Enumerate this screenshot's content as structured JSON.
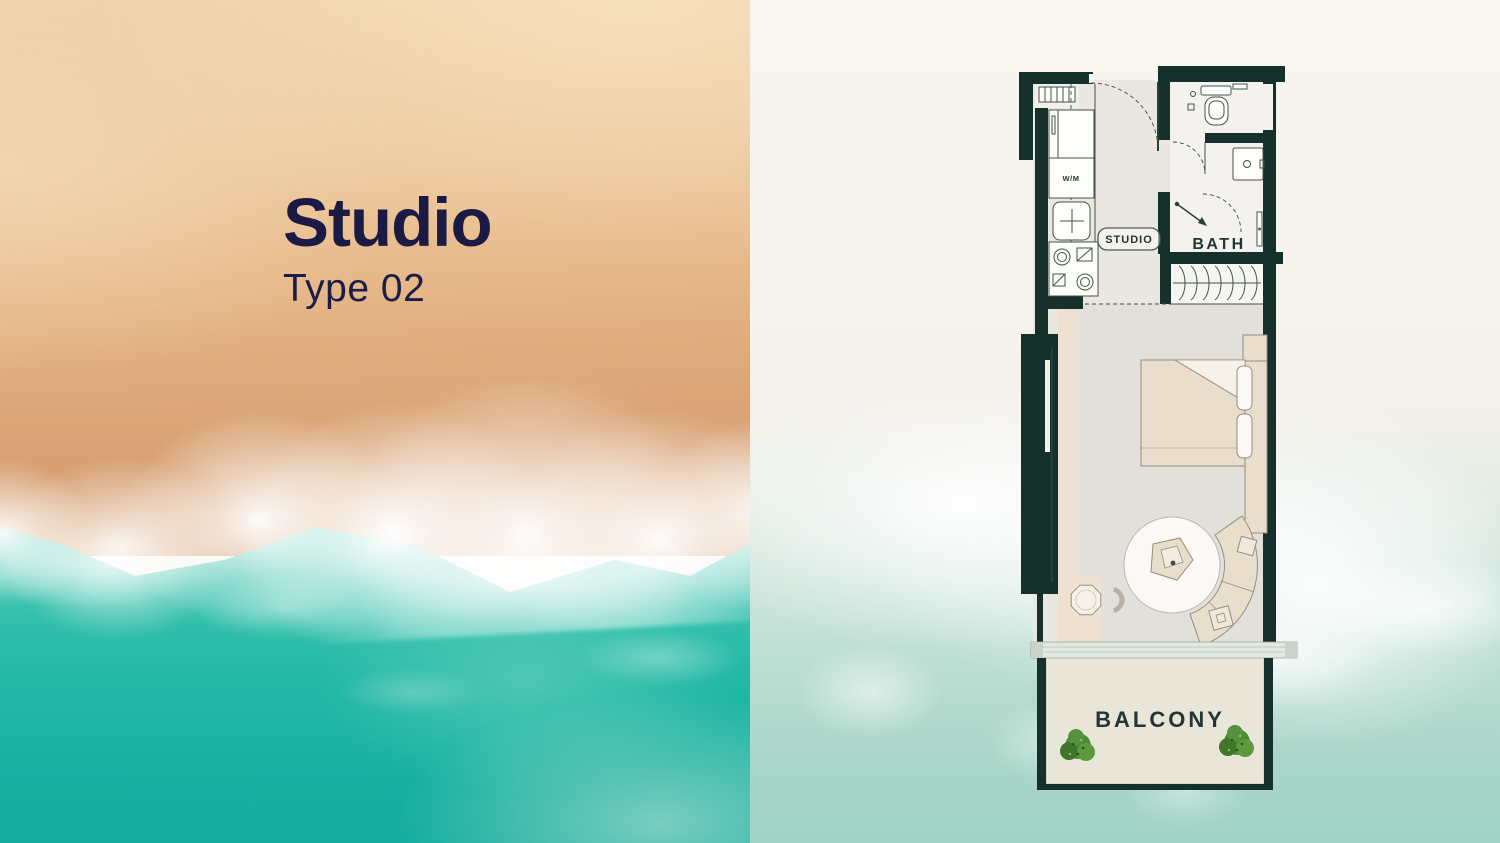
{
  "slide": {
    "title": "Studio",
    "subtitle": "Type 02"
  },
  "plan": {
    "labels": {
      "studio": "STUDIO",
      "bath": "BATH",
      "balcony": "BALCONY",
      "washing_machine": "W/M"
    }
  },
  "colors": {
    "title_text": "#1a1a44",
    "plan_walls": "#16302b",
    "plan_label_text": "#223731",
    "sand": "#e7ba8b",
    "ocean": "#21b7a6",
    "foam": "#ffffff",
    "balcony_plant": "#4e8a33",
    "furniture": "#e9ddcc"
  }
}
